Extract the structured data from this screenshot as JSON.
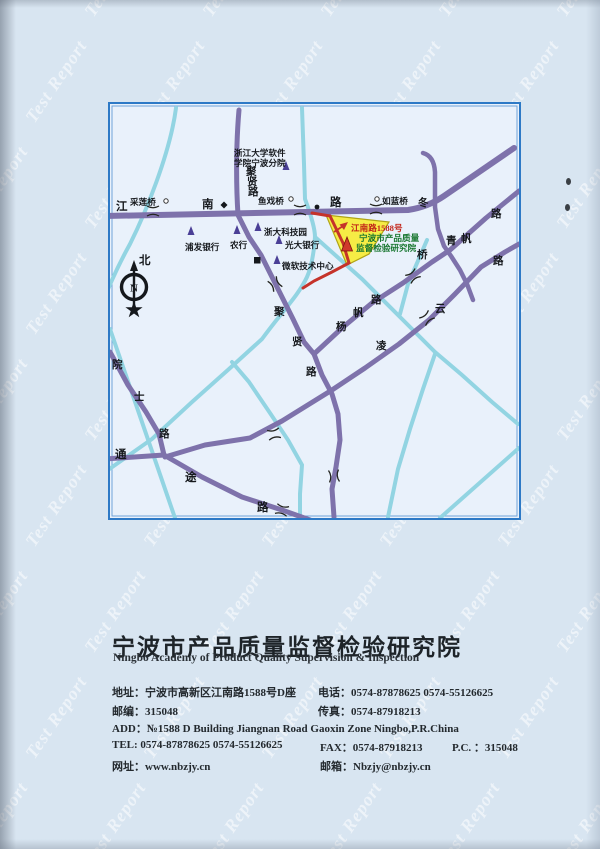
{
  "page": {
    "watermark": "Test Report"
  },
  "map": {
    "compass_n": "N",
    "labels": [
      "浙江大学软件",
      "学院宁波分院",
      "聚",
      "贤",
      "路",
      "采莲桥",
      "江",
      "南",
      "路",
      "鱼戏桥",
      "如蓝桥",
      "浙大科技园",
      "浦发银行",
      "农行",
      "光大银行",
      "微软技术中心",
      "江南路1588号",
      "宁波市产品质量",
      "监督检验研究院",
      "聚",
      "贤",
      "路",
      "杨",
      "帆",
      "路",
      "凌",
      "云",
      "路",
      "冬",
      "路",
      "青",
      "帆",
      "桥",
      "通",
      "途",
      "路",
      "院",
      "士",
      "路",
      "北"
    ]
  },
  "footer": {
    "title_cn": "宁波市产品质量监督检验研究院",
    "title_en": "Ningbo Academy of Product Quality Supervision & Inspection",
    "address": "地址：宁波市高新区江南路1588号D座",
    "phone": "电话：0574-87878625  0574-55126625",
    "postcode": "邮编：315048",
    "fax": "传真：0574-87918213",
    "add_en": "ADD：№1588 D Building Jiangnan Road Gaoxin Zone Ningbo,P.R.China",
    "tel_en": "TEL: 0574-87878625  0574-55126625",
    "fax_en": "FAX：0574-87918213",
    "pc_en": "P.C. ：315048",
    "website": "网址：www.nbzjy.cn",
    "email": "邮箱：Nbzjy@nbzjy.cn"
  }
}
